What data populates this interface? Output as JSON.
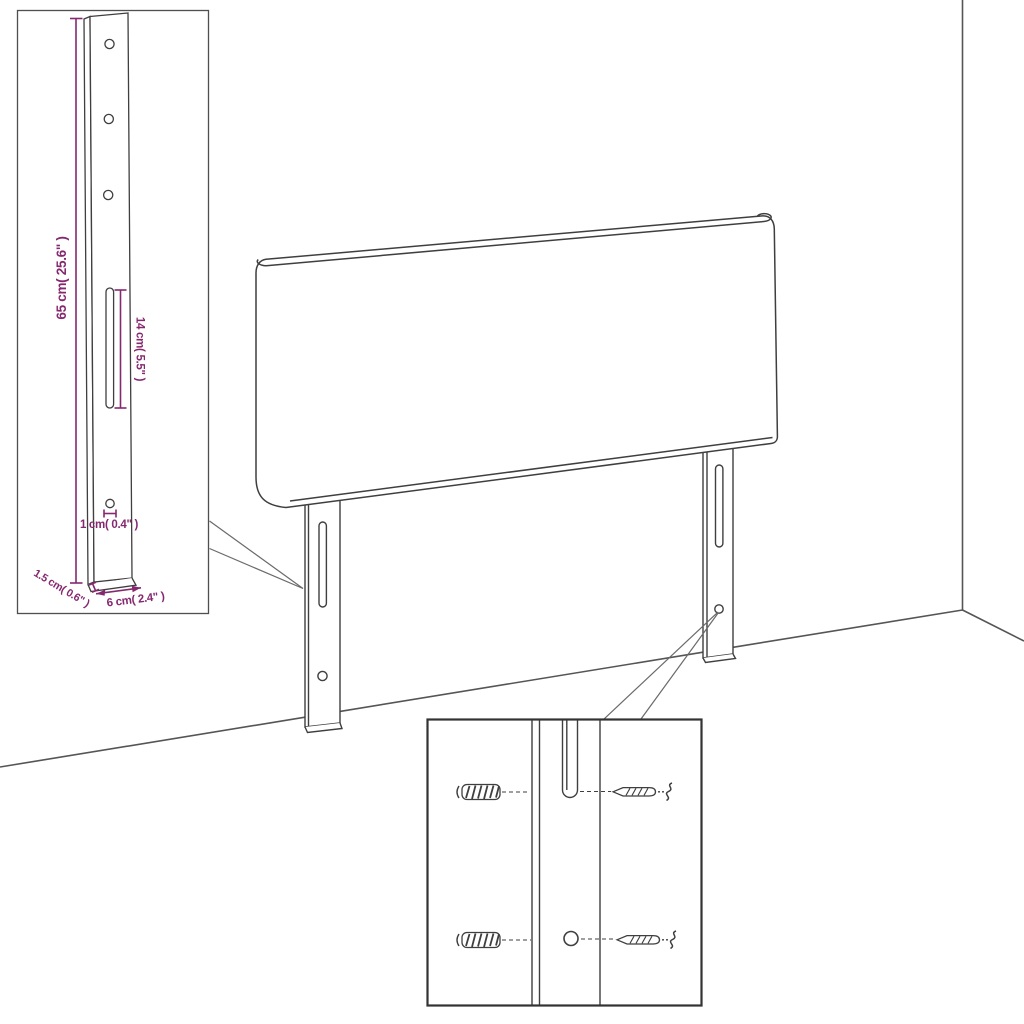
{
  "colors": {
    "line": "#3f3f3f",
    "room_line": "#555555",
    "dimension": "#85286f",
    "background": "#ffffff",
    "inset_border": "#4f4f4f",
    "detail_box_border": "#333333"
  },
  "dimensions": {
    "height": "65 cm( 25.6\" )",
    "slot": "14 cm( 5.5\" )",
    "hole": "1 cm( 0.4\" )",
    "depth": "1.5 cm( 0.6\" )",
    "width": "6 cm( 2.4\" )"
  }
}
